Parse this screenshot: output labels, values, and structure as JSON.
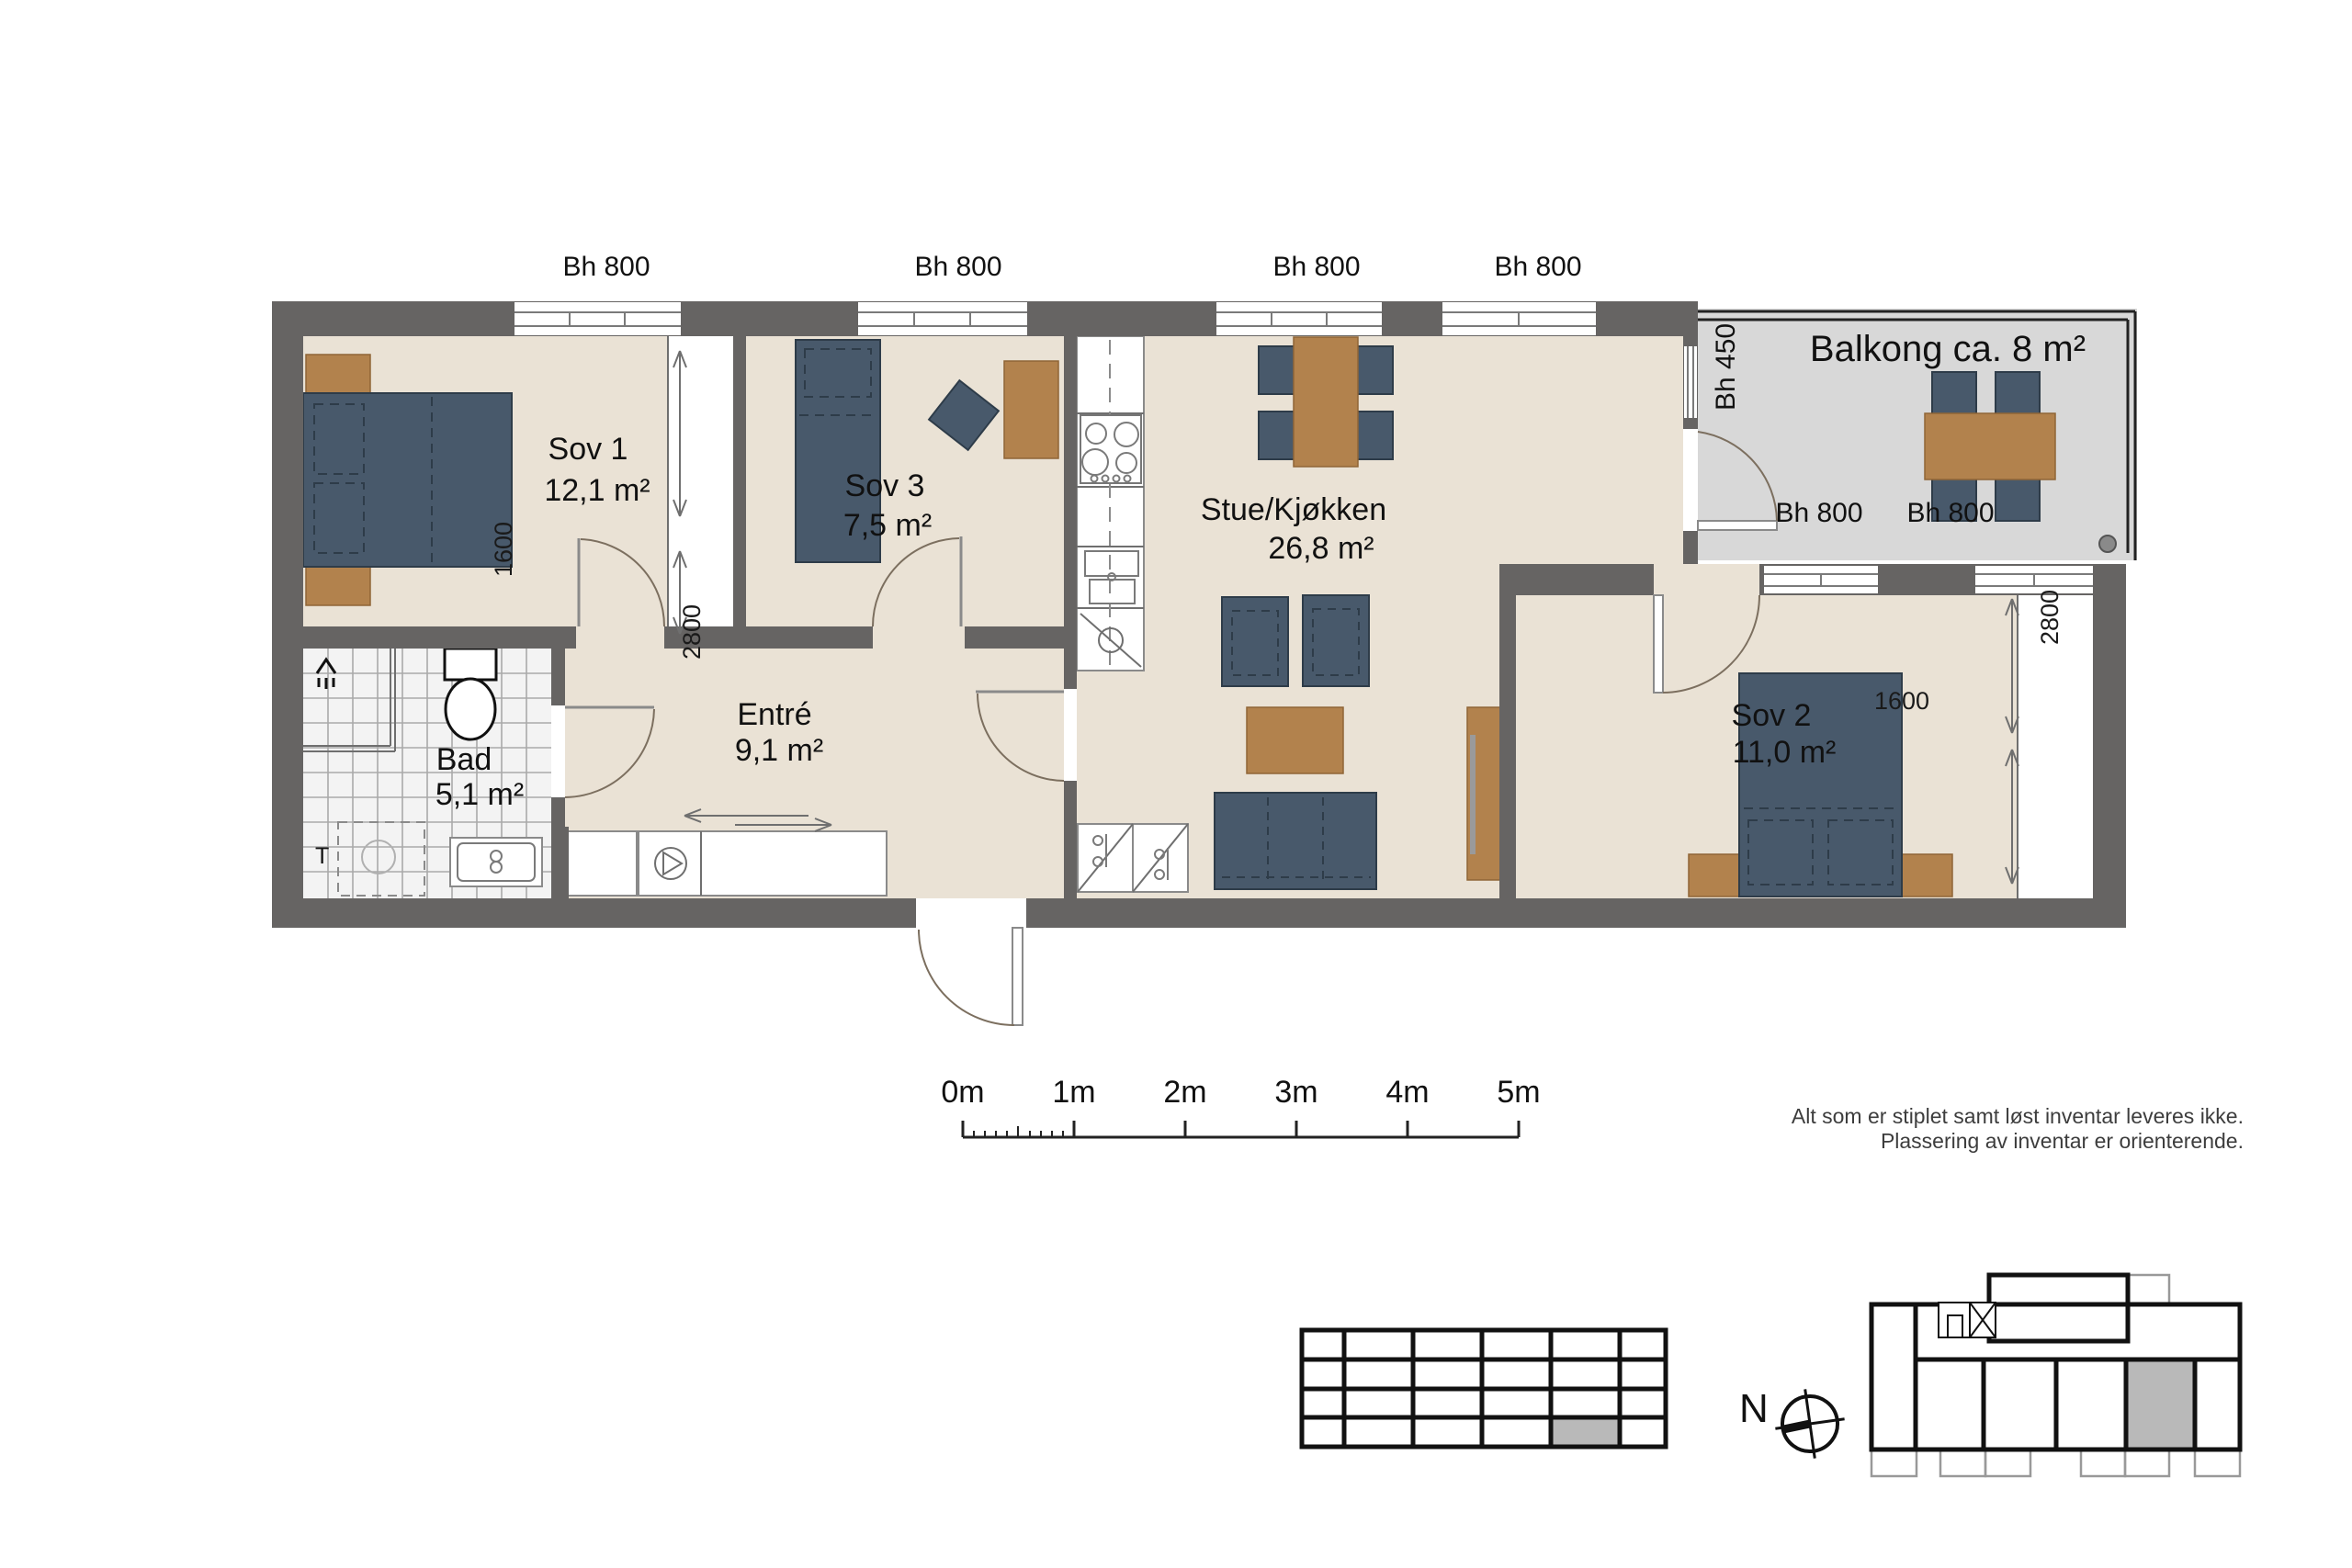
{
  "plan_title": "Apartment floor plan",
  "rooms": [
    {
      "id": "sov1",
      "name": "Sov 1",
      "area": "12,1 m²"
    },
    {
      "id": "sov3",
      "name": "Sov 3",
      "area": "7,5 m²"
    },
    {
      "id": "stue",
      "name": "Stue/Kjøkken",
      "area": "26,8 m²"
    },
    {
      "id": "entre",
      "name": "Entré",
      "area": "9,1 m²"
    },
    {
      "id": "bad",
      "name": "Bad",
      "area": "5,1 m²"
    },
    {
      "id": "sov2",
      "name": "Sov 2",
      "area": "11,0 m²"
    }
  ],
  "balcony": {
    "label": "Balkong ca. 8 m²"
  },
  "window_labels": {
    "bh800": "Bh 800",
    "bh450": "Bh 450"
  },
  "dimensions": {
    "d1600": "1600",
    "d2800": "2800"
  },
  "bath": {
    "t_label": "T"
  },
  "scale_bar": {
    "labels": [
      "0m",
      "1m",
      "2m",
      "3m",
      "4m",
      "5m"
    ]
  },
  "notes": [
    "Alt som er stiplet samt løst inventar leveres ikke.",
    "Plassering av inventar er orienterende."
  ],
  "compass": {
    "north_label": "N"
  },
  "colors": {
    "wall": "#666463",
    "floor": "#EAE2D5",
    "balcony_floor": "#D8D8D8",
    "furniture_blue": "#48596B",
    "furniture_wood": "#B2824D",
    "keyplan_highlight": "#B9B9B9"
  }
}
